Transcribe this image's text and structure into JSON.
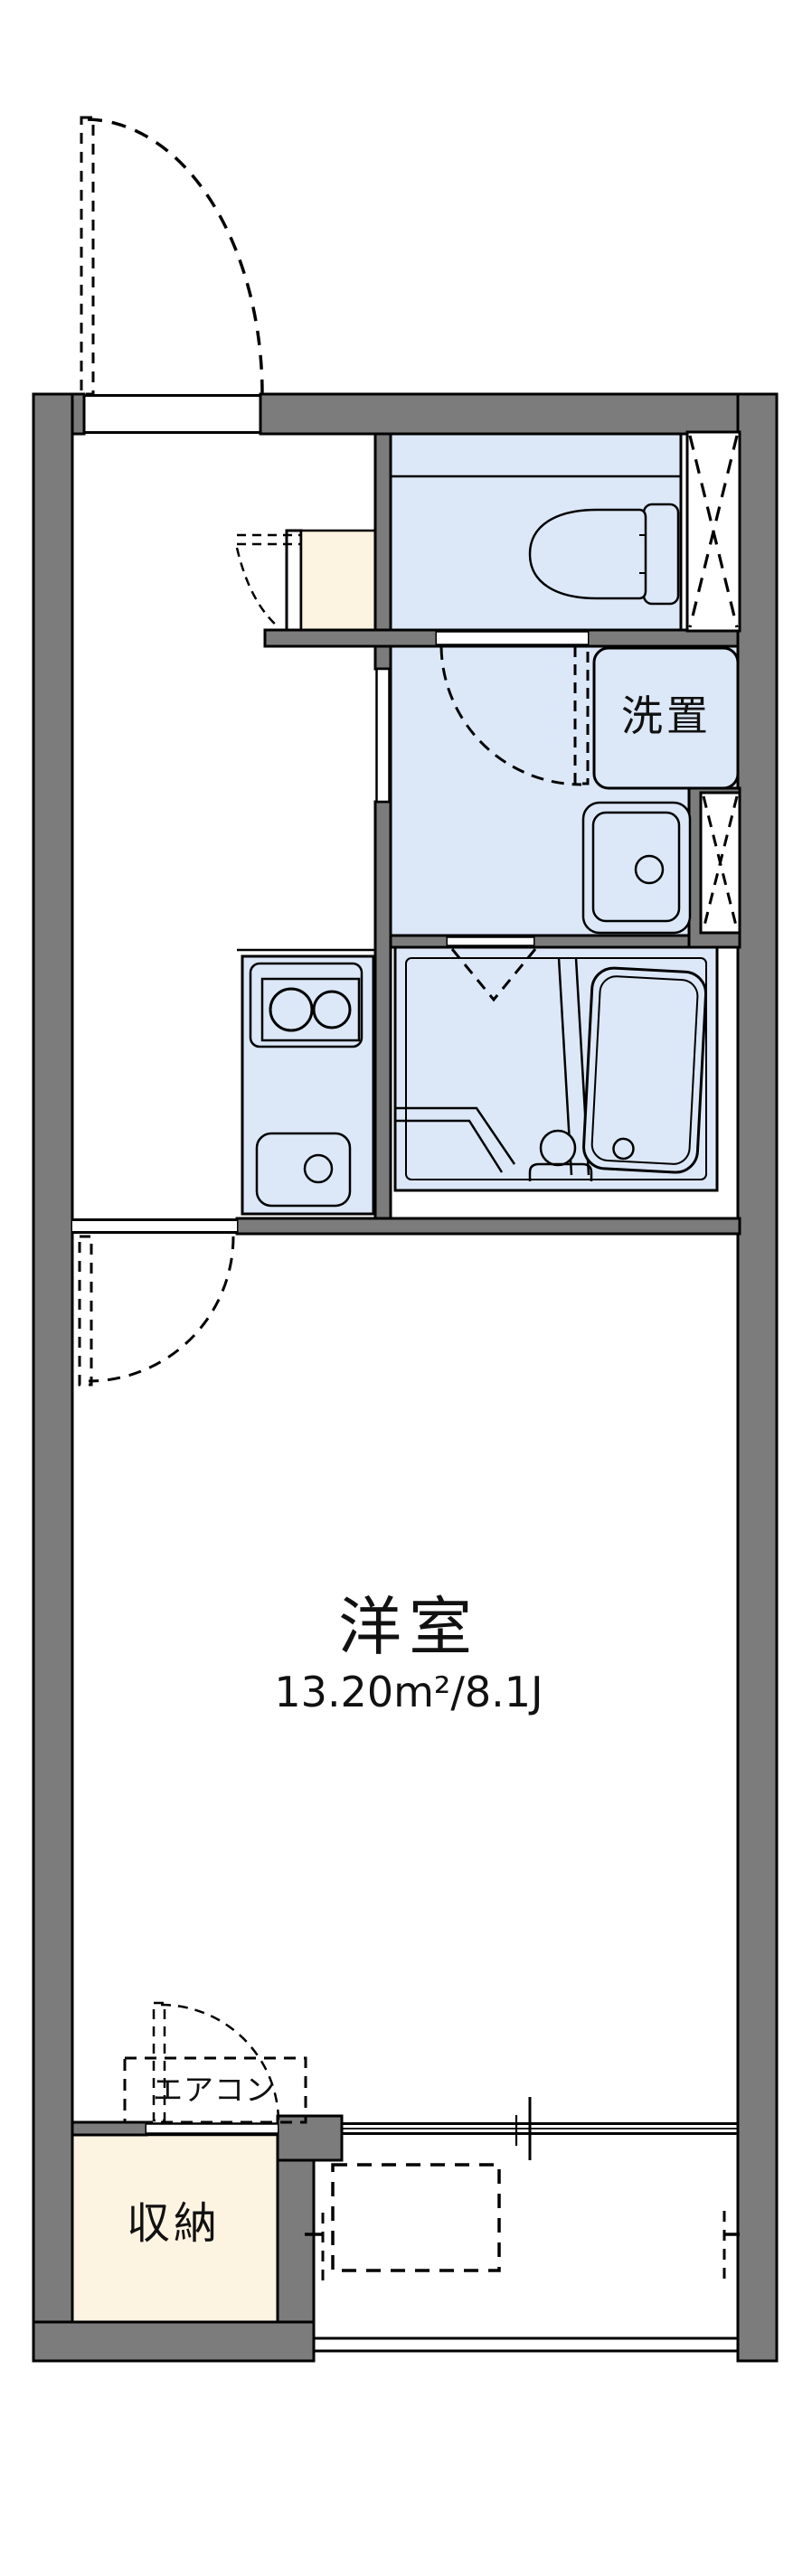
{
  "plan": {
    "type": "apartment-floor-plan",
    "labels": {
      "laundry_space": "洗置",
      "main_room": "洋室",
      "main_room_size": "13.20m²/8.1J",
      "aircon": "エアコン",
      "storage": "収納"
    },
    "colors": {
      "wall": "#7c7c7c",
      "wet_area": "#dce8f8",
      "storage_floor": "#fdf3e1",
      "line": "#000000",
      "background": "#ffffff"
    }
  }
}
